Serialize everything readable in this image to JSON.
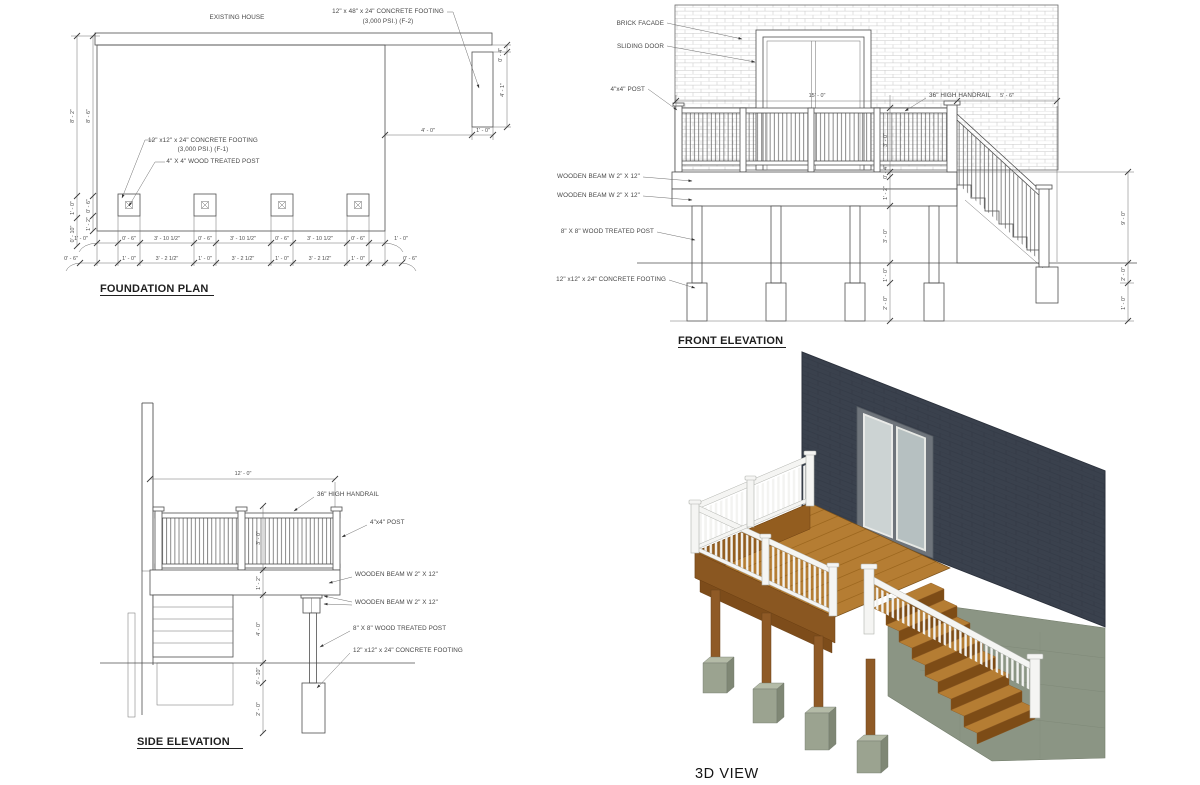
{
  "palette": {
    "line": "#4f4f4f",
    "wall_dark": "#3a414d",
    "deck_wood": "#b57d33",
    "fascia_wood": "#8a5721",
    "railing_white": "#f4f4f2",
    "footing_concrete": "#9ba390",
    "foundation_green": "#8b9584",
    "door_glass": "#ccd3d3"
  },
  "foundation": {
    "title": "FOUNDATION PLAN",
    "existing_house": "EXISTING HOUSE",
    "f2_note_1": "12\" x 48\" x 24\" CONCRETE FOOTING",
    "f2_note_2": "(3,000 PSI.)  (F-2)",
    "f1_note_1": "12\" x12\" x 24\" CONCRETE FOOTING",
    "f1_note_2": "(3,000 PSI.)  (F-1)",
    "post_note": "4\" X 4\" WOOD TREATED POST",
    "dims": {
      "left_outer": [
        "8' - 2\"",
        "1' - 0\"",
        "0' - 10\""
      ],
      "left_inner": [
        "8' - 6\"",
        "0' - 6\"",
        "1' - 2\""
      ],
      "f2_top": "0' - 4\"",
      "f2_len": "4' - 1\"",
      "f2_gap": "4' - 0\"",
      "f2_width": "1' - 0\"",
      "row1": [
        "1' - 0\"",
        "0' - 6\"",
        "3' - 10 1/2\"",
        "0' - 6\"",
        "3' - 10 1/2\"",
        "0' - 6\"",
        "3' - 10 1/2\"",
        "0' - 6\"",
        "1' - 0\""
      ],
      "row2": [
        "0' - 6\"",
        "1' - 0\"",
        "3' - 2 1/2\"",
        "1' - 0\"",
        "3' - 2 1/2\"",
        "1' - 0\"",
        "3' - 2 1/2\"",
        "1' - 0\"",
        "0' - 6\""
      ]
    }
  },
  "front": {
    "title": "FRONT ELEVATION",
    "labels": {
      "brick": "BRICK FACADE",
      "door": "SLIDING DOOR",
      "post44": "4\"x4\" POST",
      "handrail": "36\" HIGH HANDRAIL",
      "beam1": "WOODEN BEAM W 2\" X 12\"",
      "beam2": "WOODEN BEAM W 2\" X 12\"",
      "post88": "8\" X 8\" WOOD TREATED POST",
      "footing": "12\" x12\" x 24\" CONCRETE FOOTING"
    },
    "dims": {
      "deck_width": "15' - 0\"",
      "stair_run": "5' - 6\"",
      "right": [
        "9' - 0\"",
        "2' - 0\"",
        "1' - 0\""
      ],
      "mid": [
        "3' - 0\"",
        "0' - 4\"",
        "1' - 2\"",
        "3' - 0\"",
        "1' - 0\"",
        "2' - 0\""
      ]
    }
  },
  "side": {
    "title": "SIDE ELEVATION",
    "labels": {
      "handrail": "36\" HIGH HANDRAIL",
      "post44": "4\"x4\" POST",
      "beam1": "WOODEN BEAM W 2\" X 12\"",
      "beam2": "WOODEN BEAM W 2\" X 12\"",
      "post88": "8\" X 8\" WOOD TREATED POST",
      "footing": "12\" x12\" x 24\" CONCRETE FOOTING"
    },
    "dims": {
      "depth": "12' - 0\"",
      "chain": [
        "3' - 0\"",
        "1' - 2\"",
        "4' - 0\"",
        "0' - 10\"",
        "2' - 0\""
      ]
    }
  },
  "view3d": {
    "title": "3D VIEW"
  }
}
